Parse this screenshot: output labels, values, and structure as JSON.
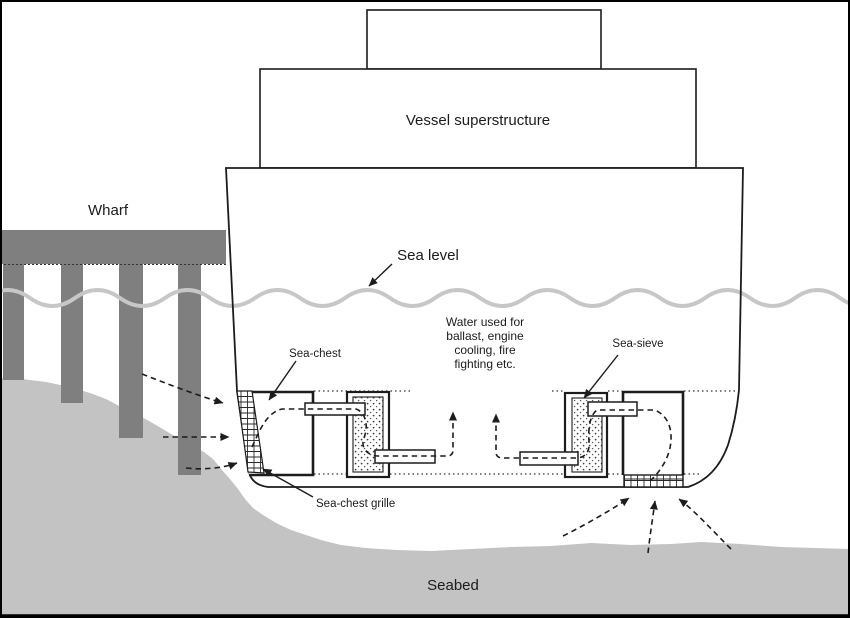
{
  "labels": {
    "wharf": "Wharf",
    "vessel_superstructure": "Vessel superstructure",
    "sea_level": "Sea level",
    "water_note_lines": [
      "Water used for",
      "ballast, engine",
      "cooling, fire",
      "fighting etc."
    ],
    "sea_chest": "Sea-chest",
    "sea_sieve": "Sea-sieve",
    "sea_chest_grille": "Sea-chest grille",
    "seabed": "Seabed"
  },
  "colors": {
    "ink": "#1c1c1c",
    "wharf_gray": "#7f7f7f",
    "seabed_gray": "#c3c3c3",
    "wave_gray": "#c7c7c7",
    "background": "#ffffff"
  }
}
